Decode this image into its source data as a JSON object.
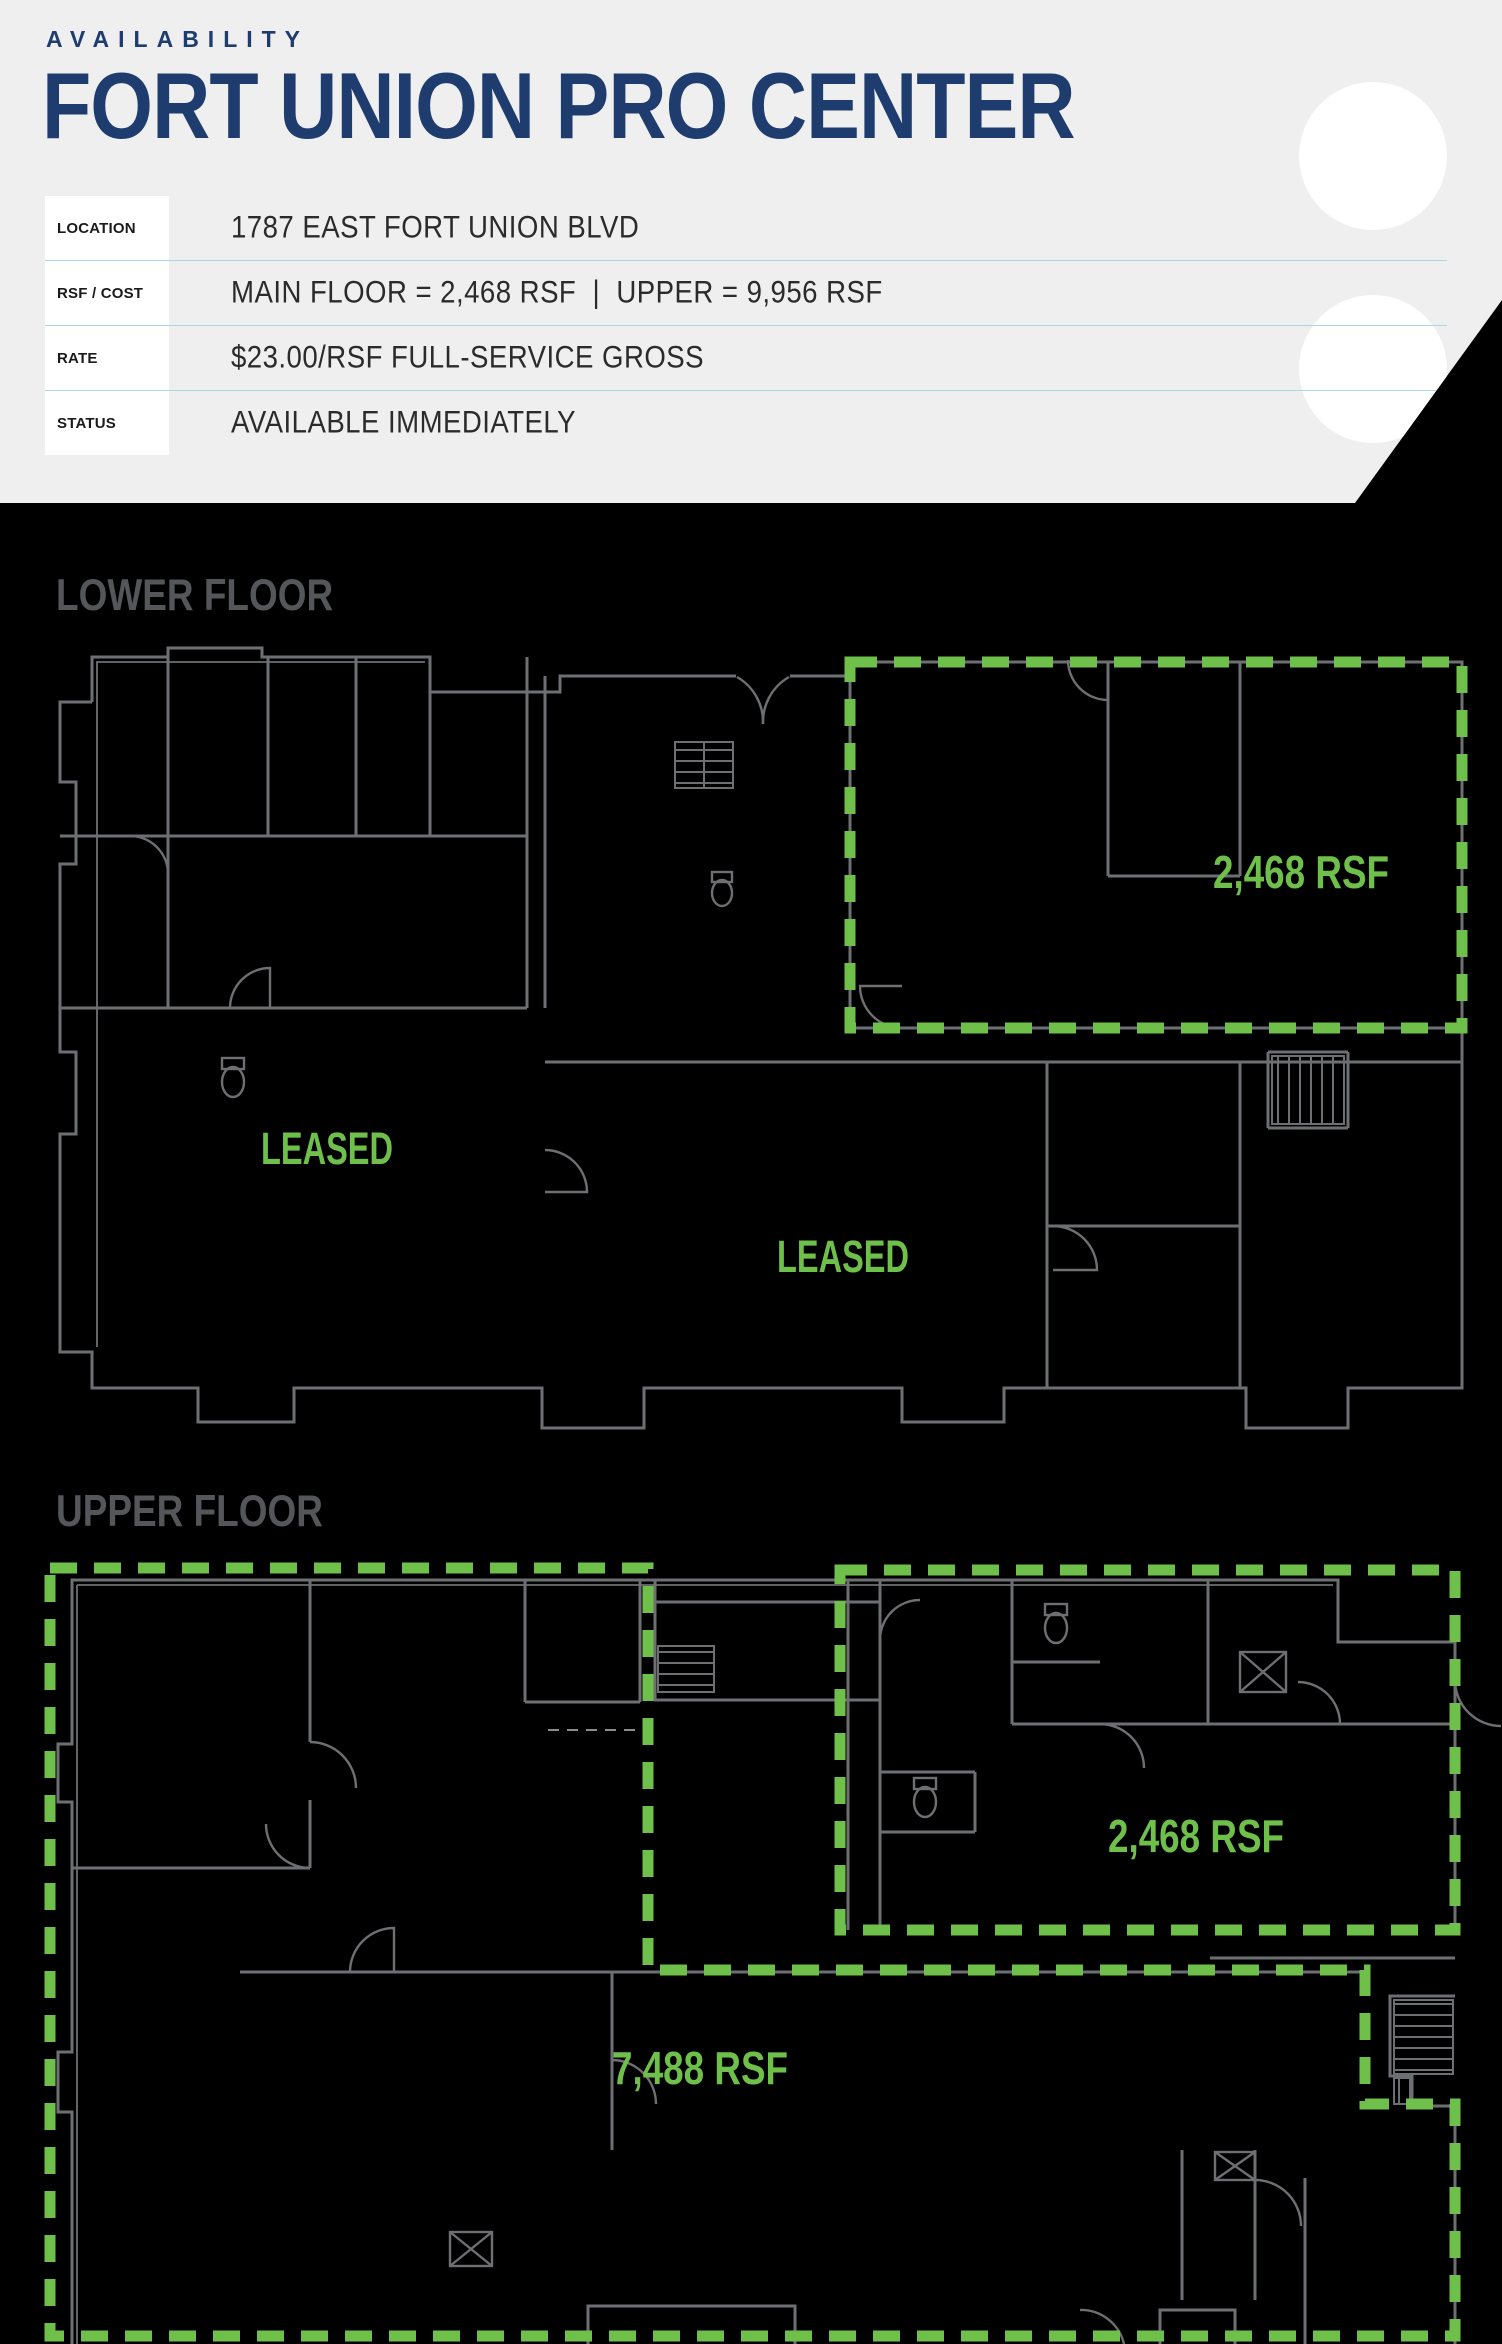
{
  "header": {
    "eyebrow": "AVAILABILITY",
    "title": "FORT UNION PRO CENTER",
    "info_rows": [
      {
        "label": "LOCATION",
        "value": "1787 EAST FORT UNION BLVD"
      },
      {
        "label": "RSF / COST",
        "value": "MAIN FLOOR = 2,468 RSF  |  UPPER = 9,956 RSF"
      },
      {
        "label": "RATE",
        "value": "$23.00/RSF FULL-SERVICE GROSS"
      },
      {
        "label": "STATUS",
        "value": "AVAILABLE IMMEDIATELY"
      }
    ]
  },
  "floors": {
    "lower": {
      "heading": "LOWER FLOOR",
      "suite_label": "2,468 RSF",
      "leased_label_1": "LEASED",
      "leased_label_2": "LEASED"
    },
    "upper": {
      "heading": "UPPER FLOOR",
      "suite_label": "2,468 RSF",
      "large_suite_label": "7,488 RSF"
    }
  },
  "colors": {
    "background": "#000000",
    "header_bg": "#efeff0",
    "navy": "#1e3c6e",
    "available_green": "#6fbf4b",
    "wall_gray": "#6e6f72",
    "floor_heading_gray": "#55565a",
    "separator_blue": "#a9d8e2",
    "circle_white": "#ffffff"
  }
}
